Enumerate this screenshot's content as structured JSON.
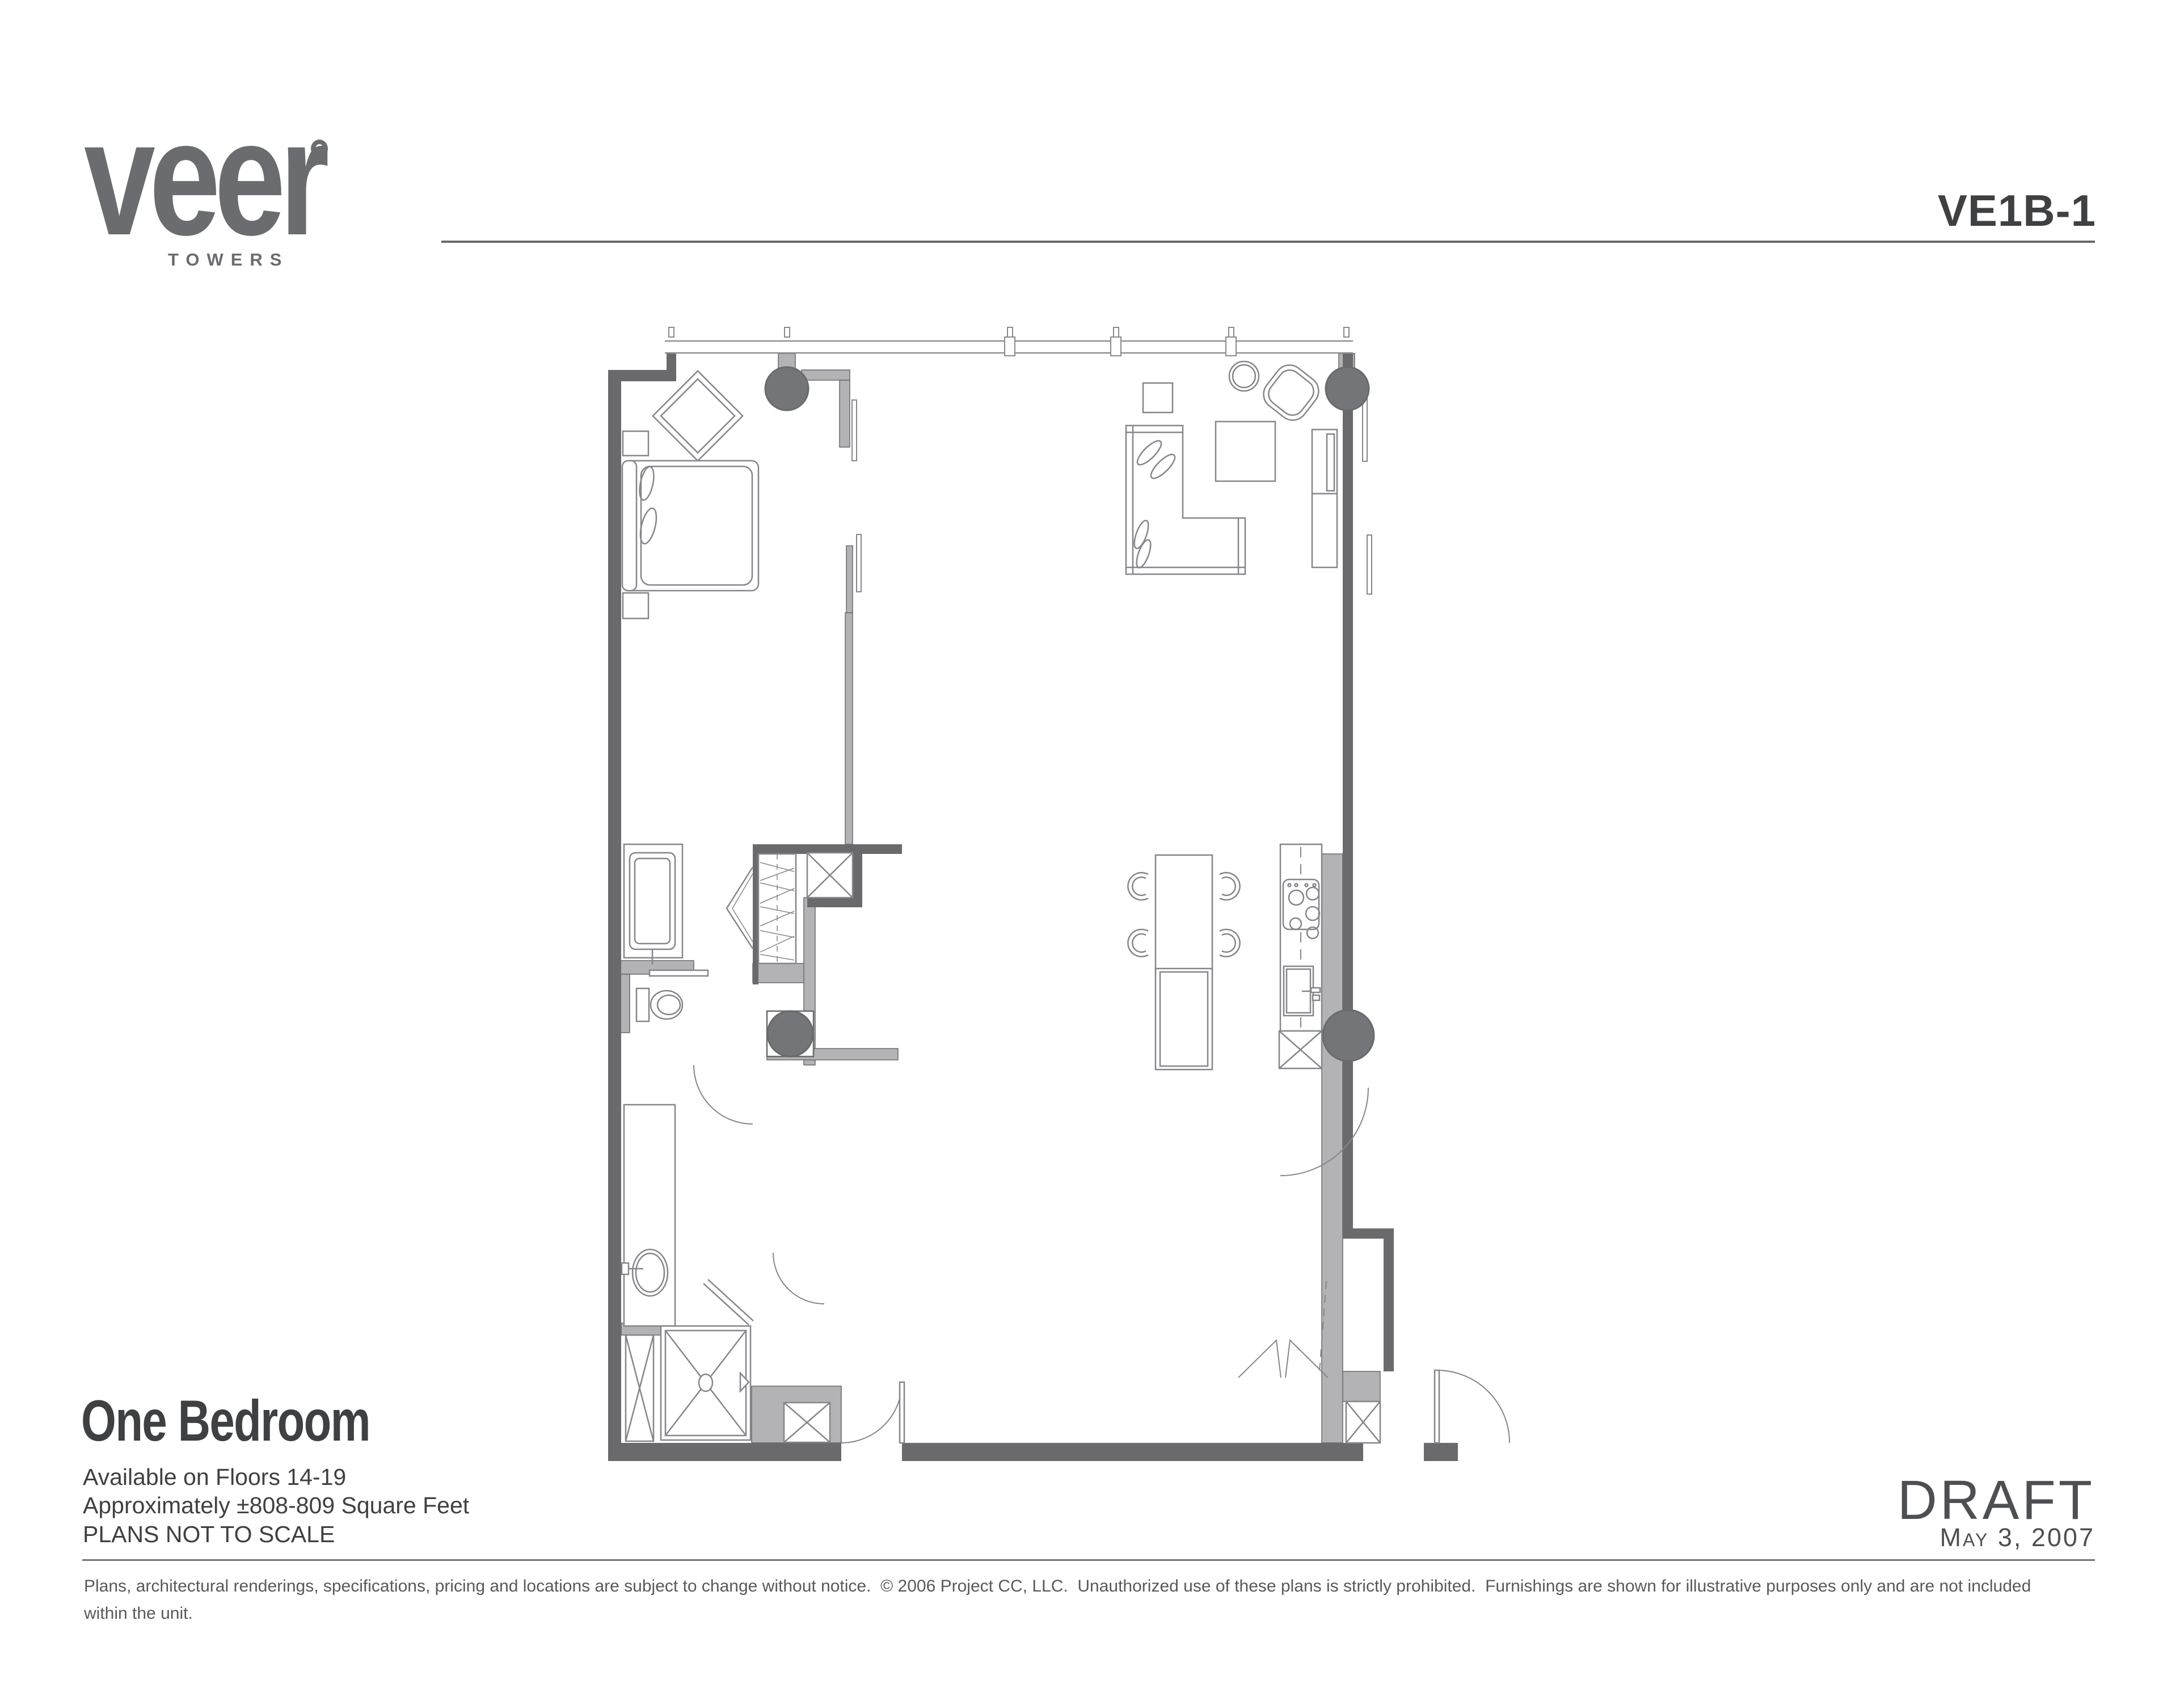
{
  "header": {
    "logo_text": "veer",
    "logo_sub": "TOWERS",
    "plan_code": "VE1B-1"
  },
  "plan_info": {
    "title": "One Bedroom",
    "availability": "Available on Floors 14-19",
    "area": "Approximately ±808-809 Square Feet",
    "scale_note": "PLANS NOT TO SCALE"
  },
  "footer": {
    "status": "DRAFT",
    "date": "May 3, 2007",
    "disclaimer": "Plans, architectural renderings, specifications, pricing and locations are subject to change without notice.  © 2006 Project CC, LLC.  Unauthorized use of these plans is strictly prohibited.  Furnishings are shown for illustrative purposes only and are not included within the unit."
  },
  "colors": {
    "wall_dark": "#6a6a6d",
    "wall_light": "#b3b3b5",
    "column_fill": "#747578",
    "furniture_line": "#85868a",
    "text_dark": "#3f4042",
    "text_gray": "#6b6c6f"
  },
  "floorplan": {
    "features": [
      "window-wall",
      "structural-columns",
      "bed",
      "nightstands",
      "accent-chair",
      "closet",
      "bathtub",
      "toilet",
      "vanity-sink",
      "washer-dryer",
      "shower",
      "sectional-sofa",
      "coffee-table",
      "side-table",
      "round-table",
      "lounge-chair",
      "refrigerator",
      "kitchen-counter",
      "cooktop",
      "kitchen-sink",
      "dishwasher",
      "island",
      "dining-table",
      "dining-chairs",
      "entry-door"
    ]
  }
}
